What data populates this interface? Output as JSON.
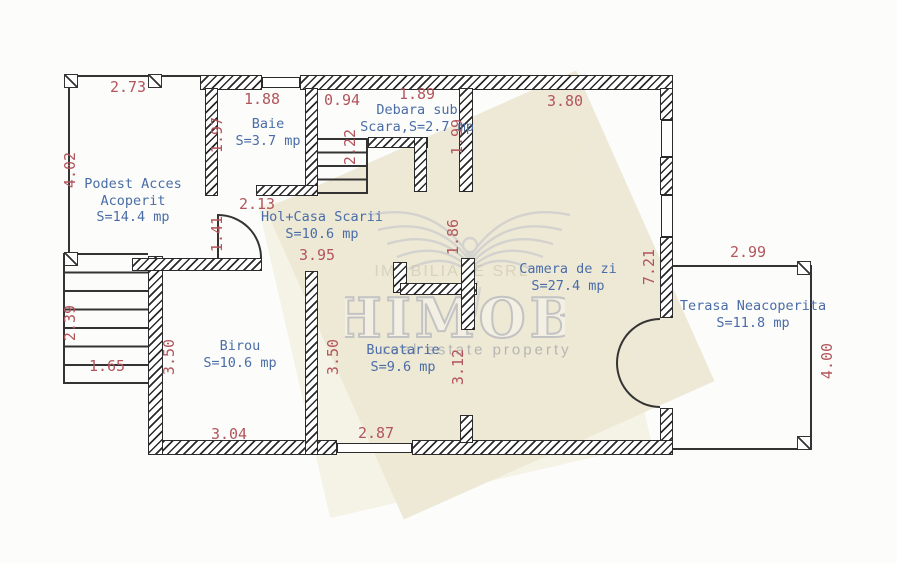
{
  "rooms": [
    {
      "line1": "Podest Acces",
      "line2": "Acoperit",
      "area": "S=14.4 mp"
    },
    {
      "line1": "Baie",
      "area": "S=3.7 mp"
    },
    {
      "line1": "Debara sub",
      "line2": "Scara,S=2.7 mp"
    },
    {
      "line1": "Hol+Casa Scarii",
      "area": "S=10.6 mp"
    },
    {
      "line1": "Camera de zi",
      "area": "S=27.4 mp"
    },
    {
      "line1": "Birou",
      "area": "S=10.6 mp"
    },
    {
      "line1": "Bucatarie",
      "area": "S=9.6 mp"
    },
    {
      "line1": "Terasa Neacoperita",
      "area": "S=11.8 mp"
    }
  ],
  "dims_h": [
    "2.73",
    "1.88",
    "0.94",
    "1.89",
    "3.80",
    "2.13",
    "3.95",
    "2.99",
    "1.65",
    "3.04",
    "2.87"
  ],
  "dims_v": [
    "4.02",
    "1.97",
    "2.22",
    "1.99",
    "1.41",
    "1.86",
    "7.21",
    "2.39",
    "3.50",
    "3.50",
    "3.12",
    "4.00"
  ],
  "watermark": {
    "brand": "HIMOB",
    "tagline": "real estate property",
    "company": "IMOBILIARE SRL"
  },
  "colors": {
    "dimension_text": "#b2555c",
    "room_text": "#4a6da8",
    "wall_line": "#2b2b2b",
    "watermark_bg": "#eae5cf",
    "watermark_fg": "#c9c9c9"
  }
}
